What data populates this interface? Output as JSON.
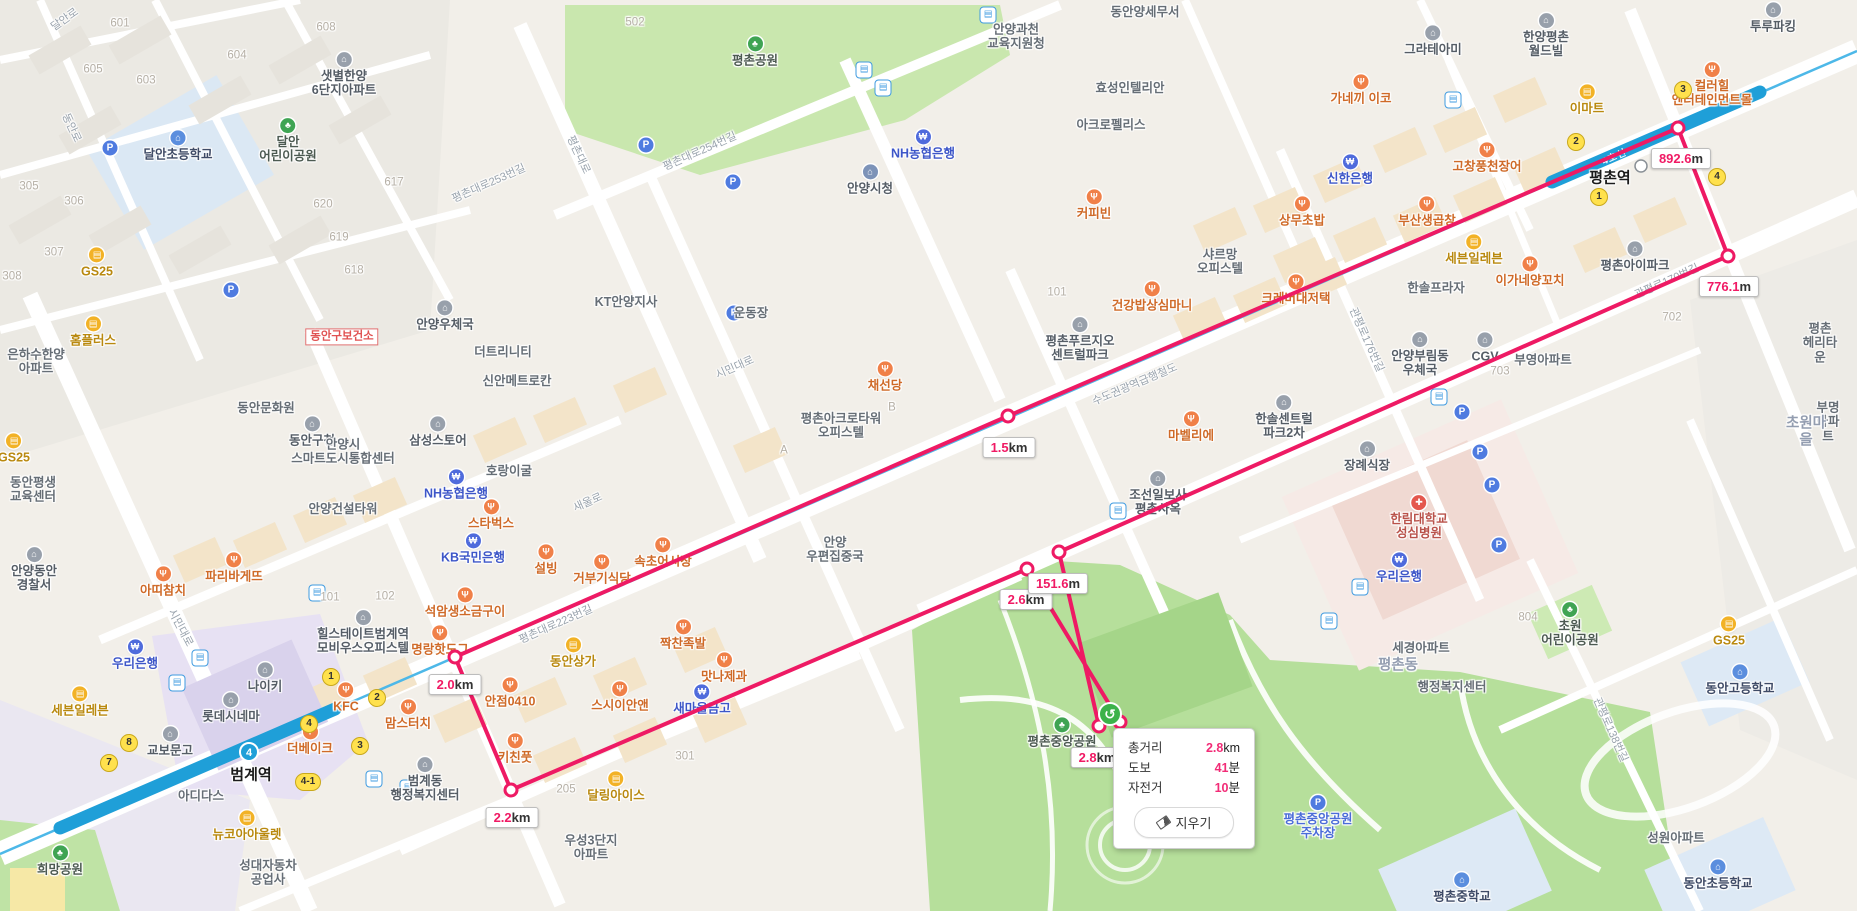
{
  "colors": {
    "route": "#ee1a64",
    "subway": "#4db8e8",
    "subway_band": "#1f9fd8",
    "undo_green": "#3cb24a",
    "accent_pink": "#f22c77",
    "label_value_pink": "#f01a64"
  },
  "summary": {
    "rows": [
      {
        "label": "총거리",
        "value": "2.8",
        "unit": "km"
      },
      {
        "label": "도보",
        "value": "41",
        "unit": "분"
      },
      {
        "label": "자전거",
        "value": "10",
        "unit": "분"
      }
    ],
    "clear_label": "지우기"
  },
  "route": {
    "points": [
      {
        "x": 1099,
        "y": 726
      },
      {
        "x": 1059,
        "y": 552,
        "label": {
          "v": "151.6",
          "u": "m",
          "lx": 1058,
          "ly": 573,
          "top": true
        }
      },
      {
        "x": 1728,
        "y": 256,
        "label": {
          "v": "776.1",
          "u": "m",
          "lx": 1729,
          "ly": 276
        }
      },
      {
        "x": 1678,
        "y": 128,
        "label": {
          "v": "892.6",
          "u": "m",
          "lx": 1681,
          "ly": 148
        }
      },
      {
        "x": 1008,
        "y": 416,
        "label": {
          "v": "1.5",
          "u": "km",
          "lx": 1009,
          "ly": 437
        }
      },
      {
        "x": 455,
        "y": 657,
        "label": {
          "v": "2.0",
          "u": "km",
          "lx": 455,
          "ly": 674
        }
      },
      {
        "x": 511,
        "y": 790,
        "label": {
          "v": "2.2",
          "u": "km",
          "lx": 512,
          "ly": 807
        }
      },
      {
        "x": 1027,
        "y": 569,
        "label": {
          "v": "2.6",
          "u": "km",
          "lx": 1026,
          "ly": 589
        }
      },
      {
        "x": 1120,
        "y": 722,
        "label": {
          "v": "2.8",
          "u": "km",
          "lx": 1097,
          "ly": 747
        }
      }
    ],
    "undo": {
      "x": 1110,
      "y": 714,
      "glyph": "↺"
    }
  },
  "subway": {
    "line_label": "4호선",
    "line_badge": "4",
    "badge_pos": {
      "x": 249,
      "y": 752
    },
    "band_label_pos": {
      "x": 1614,
      "y": 156
    },
    "station_dot": {
      "x": 1641,
      "y": 166
    }
  },
  "exits": [
    {
      "n": "1",
      "x": 331,
      "y": 677
    },
    {
      "n": "2",
      "x": 377,
      "y": 698
    },
    {
      "n": "3",
      "x": 360,
      "y": 746
    },
    {
      "n": "4",
      "x": 309,
      "y": 724
    },
    {
      "n": "4-1",
      "x": 308,
      "y": 782
    },
    {
      "n": "7",
      "x": 109,
      "y": 763
    },
    {
      "n": "8",
      "x": 129,
      "y": 743
    },
    {
      "n": "1",
      "x": 1599,
      "y": 197
    },
    {
      "n": "2",
      "x": 1576,
      "y": 142
    },
    {
      "n": "3",
      "x": 1683,
      "y": 90
    },
    {
      "n": "4",
      "x": 1717,
      "y": 177
    }
  ],
  "bus_stops": [
    {
      "x": 988,
      "y": 15
    },
    {
      "x": 864,
      "y": 70
    },
    {
      "x": 883,
      "y": 88
    },
    {
      "x": 1453,
      "y": 100
    },
    {
      "x": 317,
      "y": 593
    },
    {
      "x": 200,
      "y": 658
    },
    {
      "x": 177,
      "y": 683
    },
    {
      "x": 374,
      "y": 779
    },
    {
      "x": 408,
      "y": 788
    },
    {
      "x": 1439,
      "y": 397
    },
    {
      "x": 1360,
      "y": 587
    },
    {
      "x": 1329,
      "y": 621
    },
    {
      "x": 1118,
      "y": 511
    }
  ],
  "parking_icons": [
    {
      "x": 110,
      "y": 148
    },
    {
      "x": 231,
      "y": 290
    },
    {
      "x": 646,
      "y": 145
    },
    {
      "x": 733,
      "y": 182
    },
    {
      "x": 1462,
      "y": 412
    },
    {
      "x": 1480,
      "y": 452
    },
    {
      "x": 1492,
      "y": 485
    },
    {
      "x": 1499,
      "y": 545
    },
    {
      "x": 734,
      "y": 313
    }
  ],
  "pois": [
    {
      "t": "601",
      "x": 120,
      "y": 24,
      "k": "num"
    },
    {
      "t": "605",
      "x": 93,
      "y": 70,
      "k": "num"
    },
    {
      "t": "603",
      "x": 146,
      "y": 81,
      "k": "num"
    },
    {
      "t": "604",
      "x": 237,
      "y": 56,
      "k": "num"
    },
    {
      "t": "608",
      "x": 326,
      "y": 28,
      "k": "num"
    },
    {
      "t": "502",
      "x": 635,
      "y": 23,
      "k": "num"
    },
    {
      "t": "305",
      "x": 29,
      "y": 187,
      "k": "num"
    },
    {
      "t": "306",
      "x": 74,
      "y": 202,
      "k": "num"
    },
    {
      "t": "307",
      "x": 54,
      "y": 253,
      "k": "num"
    },
    {
      "t": "308",
      "x": 12,
      "y": 277,
      "k": "num"
    },
    {
      "t": "617",
      "x": 394,
      "y": 183,
      "k": "num"
    },
    {
      "t": "620",
      "x": 323,
      "y": 205,
      "k": "num"
    },
    {
      "t": "619",
      "x": 339,
      "y": 238,
      "k": "num"
    },
    {
      "t": "618",
      "x": 354,
      "y": 271,
      "k": "num"
    },
    {
      "t": "702",
      "x": 1672,
      "y": 318,
      "k": "num"
    },
    {
      "t": "703",
      "x": 1500,
      "y": 372,
      "k": "num"
    },
    {
      "t": "101",
      "x": 330,
      "y": 598,
      "k": "num"
    },
    {
      "t": "102",
      "x": 385,
      "y": 597,
      "k": "num"
    },
    {
      "t": "101",
      "x": 1057,
      "y": 293,
      "k": "num"
    },
    {
      "t": "205",
      "x": 566,
      "y": 790,
      "k": "num"
    },
    {
      "t": "301",
      "x": 685,
      "y": 757,
      "k": "num"
    },
    {
      "t": "804",
      "x": 1528,
      "y": 618,
      "k": "num"
    },
    {
      "t": "A",
      "x": 784,
      "y": 451,
      "k": "num"
    },
    {
      "t": "B",
      "x": 892,
      "y": 408,
      "k": "num"
    },
    {
      "t": "달안로",
      "x": 65,
      "y": 20,
      "k": "street",
      "r": -35
    },
    {
      "t": "동안로",
      "x": 71,
      "y": 128,
      "k": "street",
      "r": 65
    },
    {
      "t": "평촌대로253번길",
      "x": 489,
      "y": 184,
      "k": "street",
      "r": -24
    },
    {
      "t": "평촌대로254번길",
      "x": 700,
      "y": 152,
      "k": "street",
      "r": -24
    },
    {
      "t": "평촌대로",
      "x": 578,
      "y": 155,
      "k": "street",
      "r": 65
    },
    {
      "t": "시민대로",
      "x": 180,
      "y": 628,
      "k": "street",
      "r": 62
    },
    {
      "t": "시민대로",
      "x": 735,
      "y": 368,
      "k": "street",
      "r": -24
    },
    {
      "t": "평촌대로223번길",
      "x": 556,
      "y": 625,
      "k": "street",
      "r": -24
    },
    {
      "t": "새울로",
      "x": 588,
      "y": 503,
      "k": "street",
      "r": -24
    },
    {
      "t": "관평로176번길",
      "x": 1366,
      "y": 340,
      "k": "street",
      "r": 66
    },
    {
      "t": "관평로170번길",
      "x": 1667,
      "y": 282,
      "k": "street",
      "r": -24
    },
    {
      "t": "관평로138번길",
      "x": 1610,
      "y": 730,
      "k": "street",
      "r": 66
    },
    {
      "t": "수도권광역급행철도",
      "x": 1135,
      "y": 385,
      "k": "street",
      "r": -23
    },
    {
      "t": "평촌공원",
      "x": 755,
      "y": 52,
      "k": "park"
    },
    {
      "t": "달안\n어린이공원",
      "x": 288,
      "y": 141,
      "k": "park"
    },
    {
      "t": "희망공원",
      "x": 60,
      "y": 861,
      "k": "park"
    },
    {
      "t": "초원\n어린이공원",
      "x": 1570,
      "y": 625,
      "k": "park"
    },
    {
      "t": "평촌중앙공원",
      "x": 1062,
      "y": 733,
      "k": "park"
    },
    {
      "t": "평촌중앙공원\n주차장",
      "x": 1318,
      "y": 818,
      "k": "pklot"
    },
    {
      "t": "달안초등학교",
      "x": 178,
      "y": 146,
      "k": "school"
    },
    {
      "t": "평촌중학교",
      "x": 1462,
      "y": 888,
      "k": "school"
    },
    {
      "t": "동안고등학교",
      "x": 1740,
      "y": 680,
      "k": "school"
    },
    {
      "t": "동안초등학교",
      "x": 1718,
      "y": 875,
      "k": "school"
    },
    {
      "t": "안양시청",
      "x": 870,
      "y": 180,
      "k": "gov"
    },
    {
      "t": "안양과천\n교육지원청",
      "x": 1016,
      "y": 37,
      "k": "bizn"
    },
    {
      "t": "동안양세무서",
      "x": 1145,
      "y": 12,
      "k": "bizn"
    },
    {
      "t": "신한은행",
      "x": 1350,
      "y": 170,
      "k": "bank"
    },
    {
      "t": "NH농협은행",
      "x": 923,
      "y": 145,
      "k": "bank"
    },
    {
      "t": "NH농협은행",
      "x": 456,
      "y": 485,
      "k": "bank"
    },
    {
      "t": "KB국민은행",
      "x": 473,
      "y": 549,
      "k": "bank"
    },
    {
      "t": "우리은행",
      "x": 135,
      "y": 655,
      "k": "bank"
    },
    {
      "t": "우리은행",
      "x": 1399,
      "y": 568,
      "k": "bank"
    },
    {
      "t": "새마을금고",
      "x": 702,
      "y": 700,
      "k": "bank"
    },
    {
      "t": "이마트",
      "x": 1587,
      "y": 100,
      "k": "shop"
    },
    {
      "t": "홈플러스",
      "x": 93,
      "y": 332,
      "k": "shop"
    },
    {
      "t": "GS25",
      "x": 97,
      "y": 263,
      "k": "shop"
    },
    {
      "t": "GS25",
      "x": 14,
      "y": 449,
      "k": "shop"
    },
    {
      "t": "GS25",
      "x": 1729,
      "y": 632,
      "k": "shop"
    },
    {
      "t": "세븐일레븐",
      "x": 80,
      "y": 702,
      "k": "shop"
    },
    {
      "t": "세븐일레븐",
      "x": 1474,
      "y": 250,
      "k": "shop"
    },
    {
      "t": "동안상가",
      "x": 573,
      "y": 653,
      "k": "shop"
    },
    {
      "t": "뉴코아아울렛",
      "x": 247,
      "y": 826,
      "k": "shop"
    },
    {
      "t": "달링아이스",
      "x": 616,
      "y": 787,
      "k": "shop"
    },
    {
      "t": "컬러힐\n엔터테인먼트몰",
      "x": 1712,
      "y": 85,
      "k": "mall"
    },
    {
      "t": "투루파킹",
      "x": 1773,
      "y": 18,
      "k": "biz"
    },
    {
      "t": "가네끼 이코",
      "x": 1361,
      "y": 90,
      "k": "food"
    },
    {
      "t": "고창풍천장어",
      "x": 1487,
      "y": 158,
      "k": "food"
    },
    {
      "t": "상무초밥",
      "x": 1302,
      "y": 212,
      "k": "food"
    },
    {
      "t": "부산생곱창",
      "x": 1427,
      "y": 212,
      "k": "food"
    },
    {
      "t": "이가네양꼬치",
      "x": 1530,
      "y": 272,
      "k": "food"
    },
    {
      "t": "크레버대저택",
      "x": 1296,
      "y": 290,
      "k": "food"
    },
    {
      "t": "건강밥상심마니",
      "x": 1152,
      "y": 297,
      "k": "food"
    },
    {
      "t": "커피빈",
      "x": 1094,
      "y": 205,
      "k": "food"
    },
    {
      "t": "채선당",
      "x": 885,
      "y": 377,
      "k": "food"
    },
    {
      "t": "마벨리에",
      "x": 1191,
      "y": 427,
      "k": "food"
    },
    {
      "t": "샤르망\n오피스텔",
      "x": 1220,
      "y": 262,
      "k": "bizn"
    },
    {
      "t": "아띠참치",
      "x": 163,
      "y": 582,
      "k": "food"
    },
    {
      "t": "파리바게뜨",
      "x": 234,
      "y": 568,
      "k": "food"
    },
    {
      "t": "KFC",
      "x": 346,
      "y": 698,
      "k": "food"
    },
    {
      "t": "맘스터치",
      "x": 408,
      "y": 715,
      "k": "food"
    },
    {
      "t": "더베이크",
      "x": 310,
      "y": 740,
      "k": "food"
    },
    {
      "t": "명랑핫도그",
      "x": 440,
      "y": 641,
      "k": "food"
    },
    {
      "t": "석암생소금구이",
      "x": 465,
      "y": 603,
      "k": "food"
    },
    {
      "t": "속초어시장",
      "x": 663,
      "y": 553,
      "k": "food"
    },
    {
      "t": "거부기식당",
      "x": 602,
      "y": 570,
      "k": "food"
    },
    {
      "t": "설빙",
      "x": 546,
      "y": 560,
      "k": "food"
    },
    {
      "t": "스타벅스",
      "x": 491,
      "y": 515,
      "k": "food"
    },
    {
      "t": "안점0410",
      "x": 510,
      "y": 693,
      "k": "food"
    },
    {
      "t": "스시이안앤",
      "x": 620,
      "y": 697,
      "k": "food"
    },
    {
      "t": "키친풋",
      "x": 515,
      "y": 749,
      "k": "food"
    },
    {
      "t": "맛나제과",
      "x": 724,
      "y": 668,
      "k": "food"
    },
    {
      "t": "짝찬족발",
      "x": 683,
      "y": 635,
      "k": "food"
    },
    {
      "t": "호랑이굴",
      "x": 509,
      "y": 471,
      "k": "bizn"
    },
    {
      "t": "샛별한양\n6단지아파트",
      "x": 344,
      "y": 75,
      "k": "apt"
    },
    {
      "t": "은하수한양\n아파트",
      "x": 36,
      "y": 362,
      "k": "aptn"
    },
    {
      "t": "동안평생\n교육센터",
      "x": 33,
      "y": 490,
      "k": "bizn"
    },
    {
      "t": "안양동안\n경찰서",
      "x": 34,
      "y": 570,
      "k": "biz"
    },
    {
      "t": "동안문화원",
      "x": 266,
      "y": 408,
      "k": "bizn"
    },
    {
      "t": "동안구청",
      "x": 312,
      "y": 432,
      "k": "biz"
    },
    {
      "t": "안양시\n스마트도시통합센터",
      "x": 343,
      "y": 452,
      "k": "bizn"
    },
    {
      "t": "삼성스토어",
      "x": 438,
      "y": 432,
      "k": "biz"
    },
    {
      "t": "더트리니티",
      "x": 503,
      "y": 352,
      "k": "bizn"
    },
    {
      "t": "안양우체국",
      "x": 445,
      "y": 316,
      "k": "biz"
    },
    {
      "t": "KT안양지사",
      "x": 626,
      "y": 302,
      "k": "bizn"
    },
    {
      "t": "신안메트로칸",
      "x": 517,
      "y": 381,
      "k": "bizn"
    },
    {
      "t": "동안구보건소",
      "x": 342,
      "y": 337,
      "k": "redbox"
    },
    {
      "t": "안양건설타워",
      "x": 343,
      "y": 509,
      "k": "bizn"
    },
    {
      "t": "힐스테이트범계역\n모비우스오피스텔",
      "x": 363,
      "y": 633,
      "k": "apt"
    },
    {
      "t": "나이키",
      "x": 265,
      "y": 678,
      "k": "biz"
    },
    {
      "t": "롯데시네마",
      "x": 231,
      "y": 708,
      "k": "biz"
    },
    {
      "t": "교보문고",
      "x": 170,
      "y": 742,
      "k": "biz"
    },
    {
      "t": "아디다스",
      "x": 201,
      "y": 796,
      "k": "bizn"
    },
    {
      "t": "성대자동차\n공업사",
      "x": 268,
      "y": 873,
      "k": "bizn"
    },
    {
      "t": "우성3단지\n아파트",
      "x": 591,
      "y": 848,
      "k": "aptn"
    },
    {
      "t": "범계동\n행정복지센터",
      "x": 425,
      "y": 780,
      "k": "biz"
    },
    {
      "t": "운동장",
      "x": 751,
      "y": 313,
      "k": "bizn"
    },
    {
      "t": "평촌아크로타워\n오피스텔",
      "x": 841,
      "y": 426,
      "k": "bizn"
    },
    {
      "t": "안양\n우편집중국",
      "x": 835,
      "y": 550,
      "k": "bizn"
    },
    {
      "t": "평촌푸르지오\n센트럴파크",
      "x": 1080,
      "y": 340,
      "k": "apt"
    },
    {
      "t": "효성인텔리안",
      "x": 1130,
      "y": 88,
      "k": "bizn"
    },
    {
      "t": "아크로펠리스",
      "x": 1111,
      "y": 125,
      "k": "bizn"
    },
    {
      "t": "그라테아미",
      "x": 1433,
      "y": 41,
      "k": "biz"
    },
    {
      "t": "한양평촌\n월드빌",
      "x": 1546,
      "y": 36,
      "k": "apt"
    },
    {
      "t": "한솔프라자",
      "x": 1436,
      "y": 288,
      "k": "bizn"
    },
    {
      "t": "안양부림동\n우체국",
      "x": 1420,
      "y": 355,
      "k": "biz"
    },
    {
      "t": "CGV",
      "x": 1485,
      "y": 348,
      "k": "biz"
    },
    {
      "t": "조선일보사\n평촌사옥",
      "x": 1158,
      "y": 494,
      "k": "biz"
    },
    {
      "t": "한솔센트럴\n파크2차",
      "x": 1284,
      "y": 418,
      "k": "apt"
    },
    {
      "t": "장례식장",
      "x": 1367,
      "y": 457,
      "k": "biz"
    },
    {
      "t": "한림대학교\n성심병원",
      "x": 1419,
      "y": 518,
      "k": "hosp"
    },
    {
      "t": "평촌아이파크",
      "x": 1635,
      "y": 257,
      "k": "apt"
    },
    {
      "t": "평촌\n헤리타운",
      "x": 1820,
      "y": 343,
      "k": "aptn"
    },
    {
      "t": "부영아파트",
      "x": 1543,
      "y": 360,
      "k": "aptn"
    },
    {
      "t": "부명아파트",
      "x": 1828,
      "y": 422,
      "k": "aptn"
    },
    {
      "t": "초원마을",
      "x": 1806,
      "y": 432,
      "k": "area"
    },
    {
      "t": "평촌동",
      "x": 1398,
      "y": 666,
      "k": "area"
    },
    {
      "t": "행정복지센터",
      "x": 1452,
      "y": 687,
      "k": "bizn"
    },
    {
      "t": "세경아파트",
      "x": 1421,
      "y": 648,
      "k": "aptn"
    },
    {
      "t": "성원아파트",
      "x": 1676,
      "y": 838,
      "k": "aptn"
    },
    {
      "t": "범계역",
      "x": 251,
      "y": 775,
      "k": "station"
    },
    {
      "t": "평촌역",
      "x": 1610,
      "y": 178,
      "k": "station"
    }
  ]
}
